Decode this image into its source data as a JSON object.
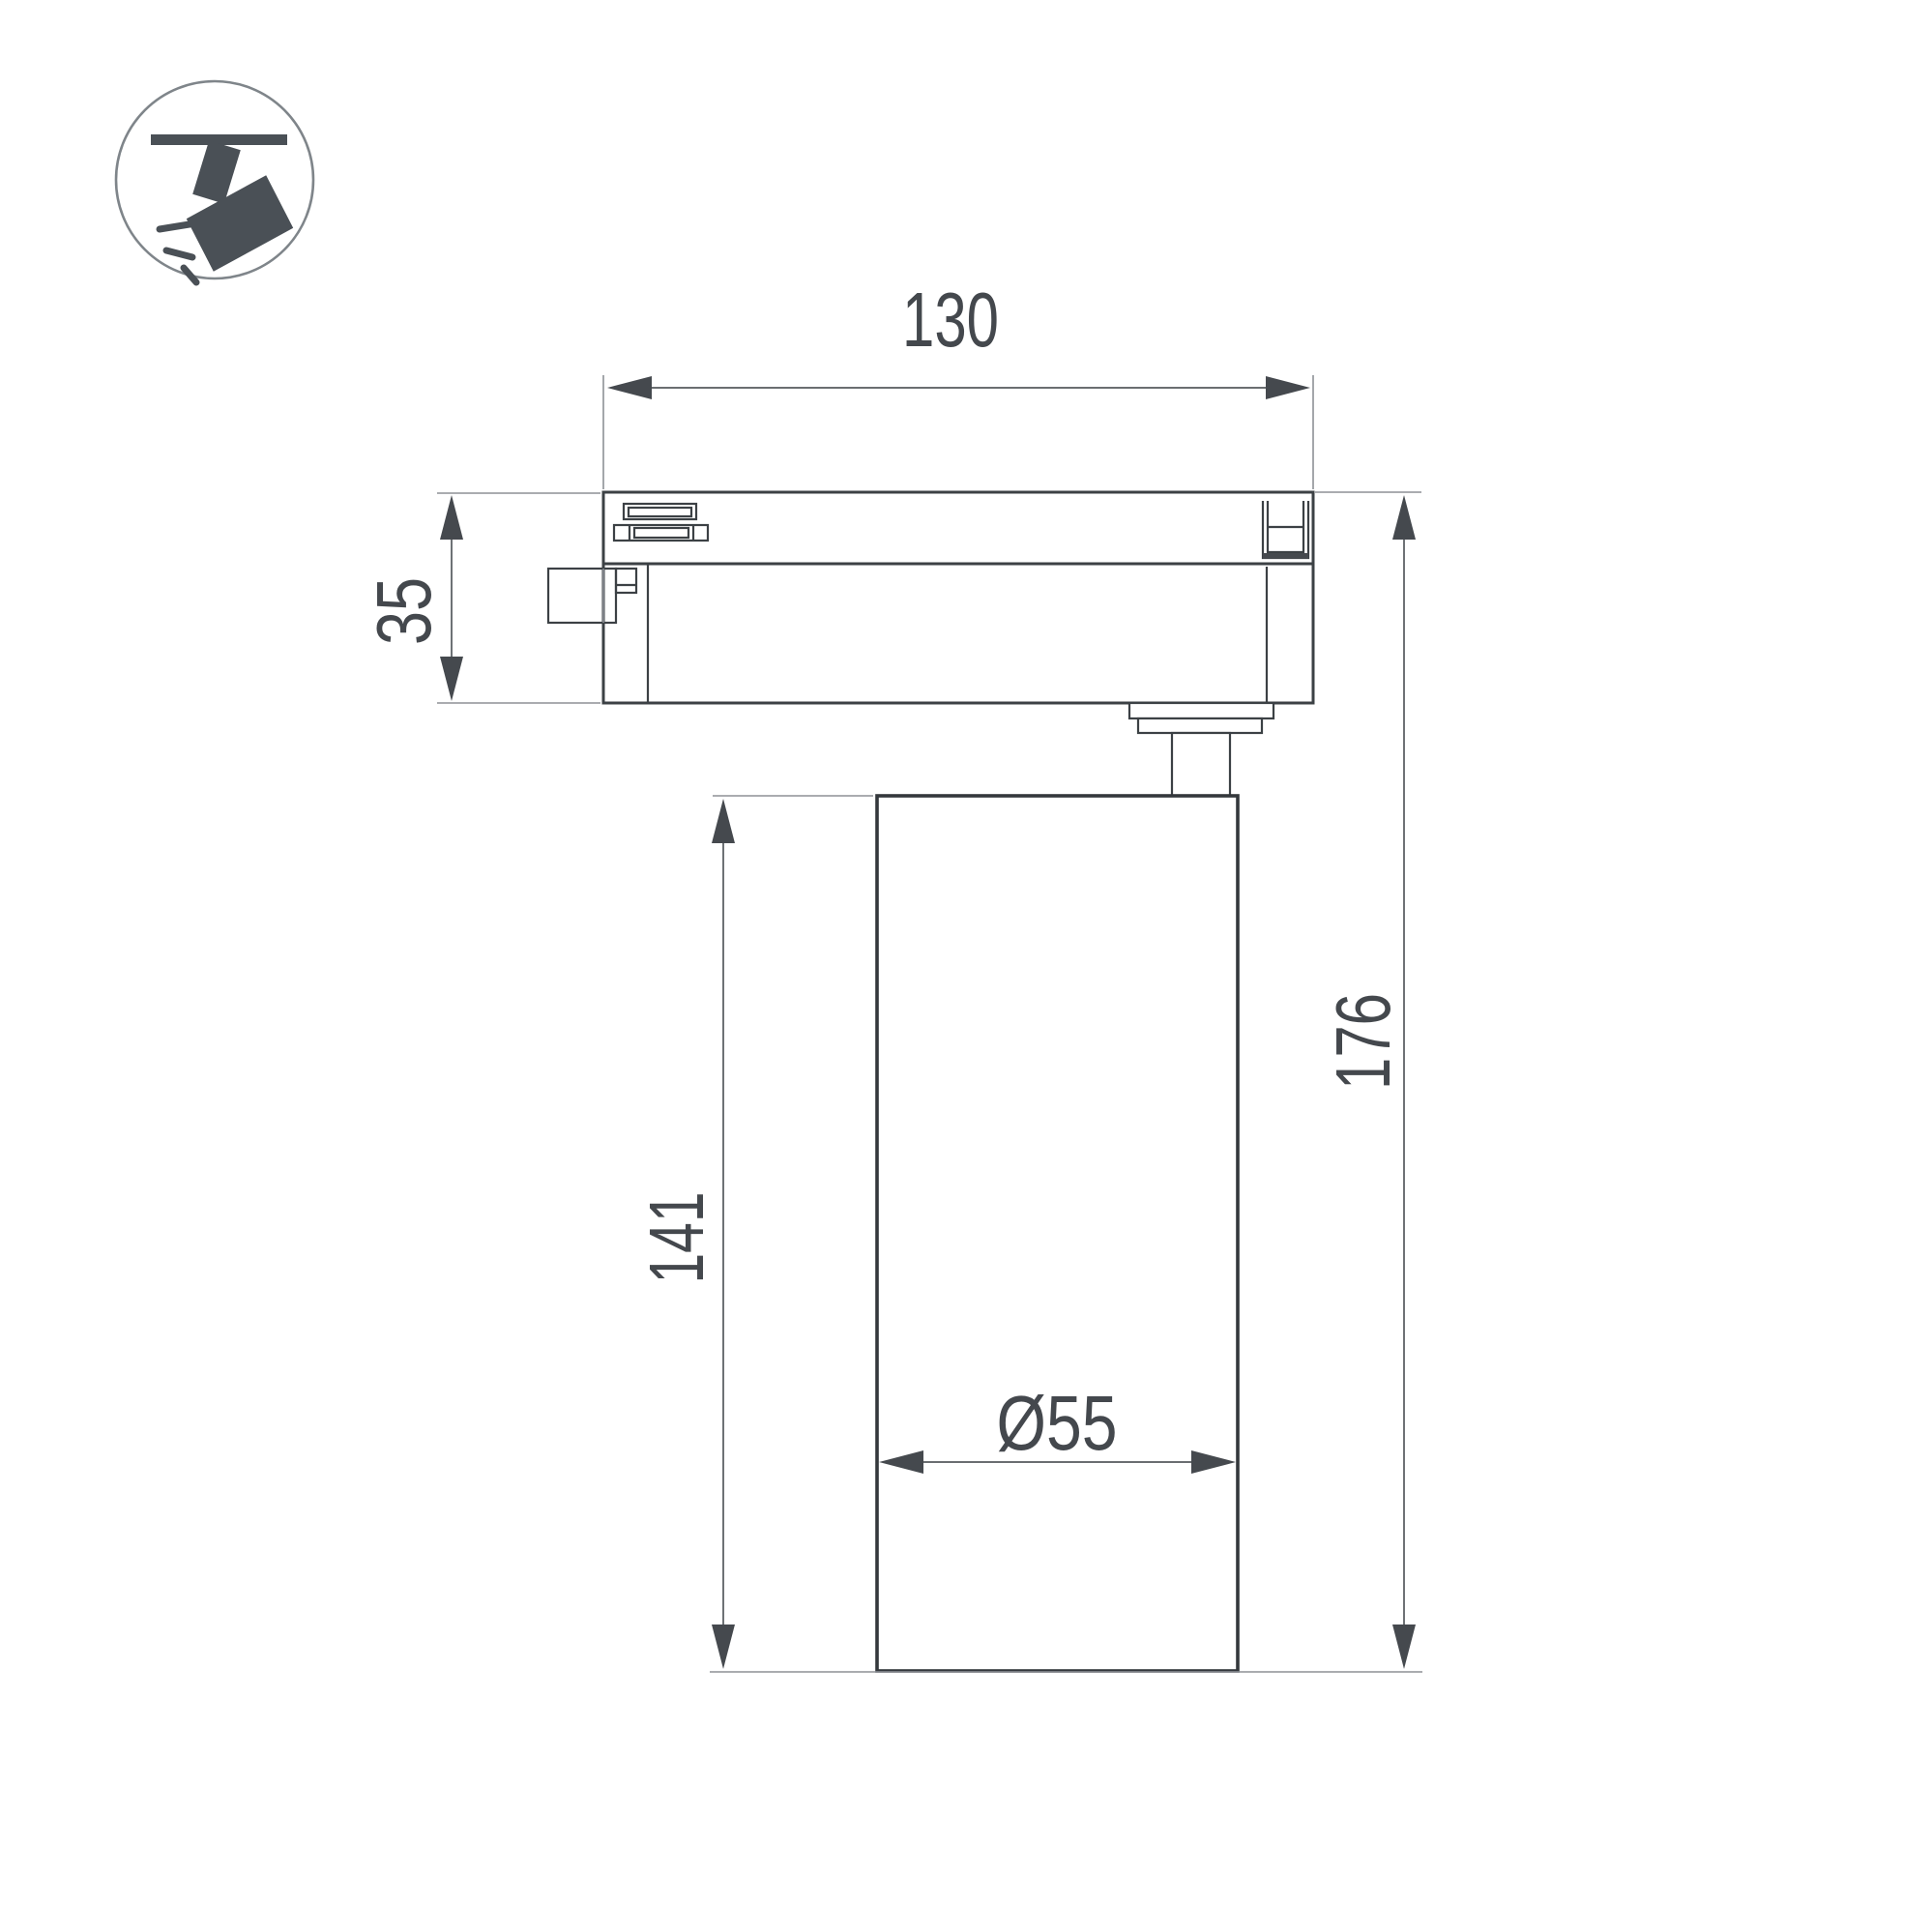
{
  "drawing": {
    "title": "track-spotlight-dimension-drawing",
    "background": "#ffffff"
  },
  "icon": {
    "name": "track-spotlight-icon",
    "glyph_color": "#4a5056",
    "ring_color": "#7f858a"
  },
  "labels": {
    "width": "130",
    "adapter_height": "35",
    "body_height": "141",
    "total_height": "176",
    "diameter": "Ø55"
  },
  "colors": {
    "outline": "#3c4145",
    "dimension_line": "#55595d",
    "extension_line": "#8d9196",
    "arrow": "#45494e",
    "text": "#44484d"
  }
}
